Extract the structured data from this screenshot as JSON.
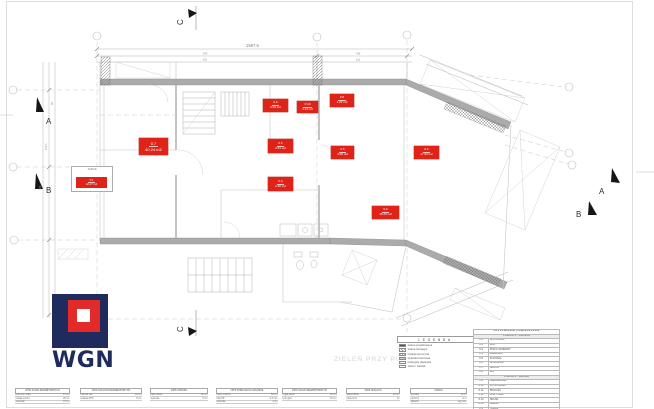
{
  "watermark": "ZIELEŃ PRZY POZIOMACH SEGMENTÓW",
  "logo": {
    "text": "WGN"
  },
  "section_markers": {
    "top_c": "C",
    "bottom_c": "C",
    "left_a": "A",
    "left_b": "B",
    "right_a": "A",
    "right_b": "B"
  },
  "dims": {
    "total": "1587.5",
    "t1": "540",
    "t2": "811",
    "t3": "436",
    "t4": "611",
    "l1": "980",
    "l2": "163.5",
    "l3": "90"
  },
  "taras": {
    "note": "TARAS",
    "num": "P.1",
    "area": "22.27 m2"
  },
  "room_labels": [
    {
      "num": "0.7",
      "area": "40.24 m2",
      "x": 139,
      "y": 138,
      "w": 29,
      "h": 17,
      "big": true
    },
    {
      "num": "0.9",
      "area": "2.04 m2",
      "x": 263,
      "y": 99,
      "w": 25,
      "h": 13
    },
    {
      "num": "0.10",
      "area": "1.14 m2",
      "x": 297,
      "y": 101,
      "w": 21,
      "h": 12
    },
    {
      "num": "0.8",
      "area": "2.02 m2",
      "x": 330,
      "y": 94,
      "w": 24,
      "h": 13
    },
    {
      "num": "0.6",
      "area": "4.61 m2",
      "x": 268,
      "y": 139,
      "w": 25,
      "h": 14
    },
    {
      "num": "0.5",
      "area": "4.08 m2",
      "x": 331,
      "y": 146,
      "w": 23,
      "h": 13
    },
    {
      "num": "0.2",
      "area": "17.94 m2",
      "x": 414,
      "y": 146,
      "w": 25,
      "h": 13
    },
    {
      "num": "0.4",
      "area": "2.48 m2",
      "x": 268,
      "y": 177,
      "w": 25,
      "h": 14
    },
    {
      "num": "0.3",
      "area": "15.29 m2",
      "x": 372,
      "y": 206,
      "w": 27,
      "h": 13
    }
  ],
  "legend": {
    "title": "LEGENDA",
    "items": [
      {
        "swatch": "solid",
        "label": "ściana projektowana"
      },
      {
        "swatch": "hatch",
        "label": "ściana istniejąca"
      },
      {
        "swatch": "cross",
        "label": "izolacja termiczna"
      },
      {
        "swatch": "gray",
        "label": "wylewka betonowa"
      },
      {
        "swatch": "dots",
        "label": "podsypka piaskowa"
      },
      {
        "swatch": "outline",
        "label": "zieleń / trawnik"
      }
    ]
  },
  "schedule": {
    "rows": [
      {
        "t": "title",
        "text": "ZESTAWIENIE POMIESZCZEŃ"
      },
      {
        "t": "head",
        "text": "POZIOM -1 · PIWNICA"
      },
      {
        "no": "0.1",
        "name": "WIATROŁAP"
      },
      {
        "no": "0.2",
        "name": "HOL"
      },
      {
        "no": "0.3",
        "name": "POKÓJ DZIENNY"
      },
      {
        "no": "0.4",
        "name": "ŁAZIENKA"
      },
      {
        "no": "0.5",
        "name": "KUCHNIA"
      },
      {
        "no": "0.6",
        "name": "SPIŻARNIA"
      },
      {
        "no": "0.7",
        "name": "SALON"
      },
      {
        "no": "0.8",
        "name": "WC"
      },
      {
        "t": "head",
        "text": "POZIOM 0 · PARTER"
      },
      {
        "no": "0.9",
        "name": "GARDEROBA"
      },
      {
        "no": "0.10",
        "name": "KOTŁOWNIA"
      },
      {
        "no": "0.11",
        "name": "PRALNIA"
      },
      {
        "no": "0.12",
        "name": "KORYTARZ"
      },
      {
        "no": "0.13",
        "name": "SKŁAD"
      },
      {
        "no": "0.14",
        "name": "GARAŻ"
      },
      {
        "no": "P.1",
        "name": "TARAS"
      },
      {
        "no": "",
        "name": "RAZEM 95.44 m2"
      }
    ]
  },
  "spec_tables": [
    {
      "x": 15,
      "w": 55,
      "title": "OPIS ŚCIAN ZEWNĘTRZNYCH",
      "rows": [
        [
          "tynk cem.-wap.",
          "1.5 cm"
        ],
        [
          "pustak ceram.",
          "25 cm"
        ],
        [
          "styropian",
          "15 cm"
        ]
      ]
    },
    {
      "x": 80,
      "w": 62,
      "title": "OPIS ŚCIAN FUNDAMENTOWYCH",
      "rows": [
        [
          "bloczek bet.",
          "24 cm"
        ],
        [
          "izolacja XPS",
          "8 cm"
        ]
      ]
    },
    {
      "x": 150,
      "w": 58,
      "title": "OPIS STROPU",
      "rows": [
        [
          "płyta żelbet.",
          "20 cm"
        ],
        [
          "wylewka",
          "5 cm"
        ]
      ]
    },
    {
      "x": 216,
      "w": 62,
      "title": "OPIS PODŁOGI NA GRUNCIE",
      "rows": [
        [
          "beton C12/15",
          "10 cm"
        ],
        [
          "folia PE",
          "0.2 mm"
        ],
        [
          "wylewka",
          "4 cm"
        ]
      ]
    },
    {
      "x": 282,
      "w": 55,
      "title": "OPIS ŚCIAN WEWNĘTRZNYCH",
      "rows": [
        [
          "cegła pełna",
          "12 cm"
        ],
        [
          "tynk gips.",
          "1.5 cm"
        ]
      ]
    },
    {
      "x": 346,
      "w": 54,
      "title": "OPIS IZOLACJI",
      "rows": [
        [
          "wełna miner.",
          "10 cm"
        ],
        [
          "papa term.",
          "2x"
        ]
      ]
    },
    {
      "x": 410,
      "w": 57,
      "title": "UWAGI",
      "rows": [
        [
          "wymiary",
          "w cm"
        ],
        [
          "poziomy",
          "w m"
        ],
        [
          "stolarka",
          "wg zest."
        ]
      ]
    }
  ]
}
